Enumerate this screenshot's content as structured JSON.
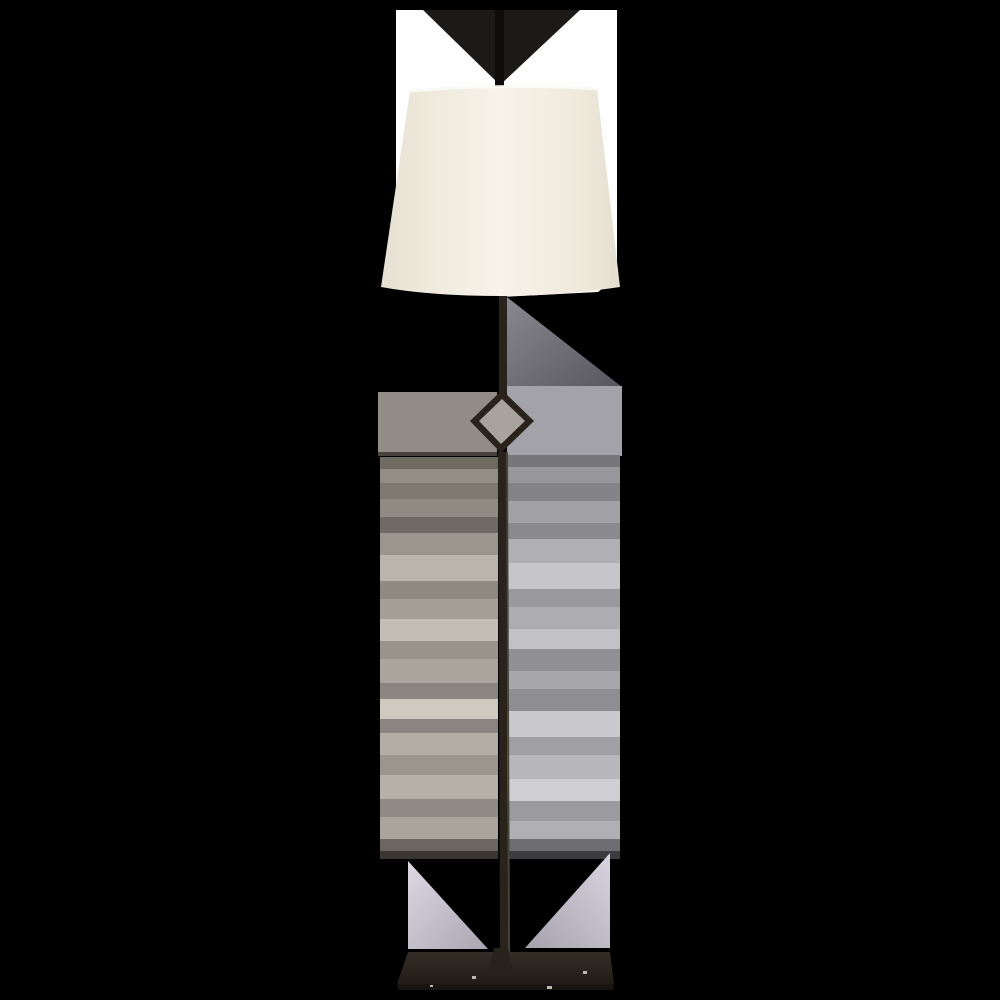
{
  "scene": {
    "subject": "wrought-iron floor lamp product photo with linen shade, diamond stem ornament and rectangular base on matted white/black background",
    "canvas": {
      "width": 1000,
      "height": 1000
    },
    "colors": {
      "background": "#000000",
      "photo_white": "#fefefe",
      "notch_triangle": "#1b1a18",
      "stem_top": "#0e0c0a",
      "stem_mid": "#29231c",
      "stem_edge": "#4a4238",
      "shade_top_highlight": "#fbfaf5",
      "band_left": "#918d86",
      "band_right": "#a2a2a8",
      "seam_line": "#46433c",
      "base_front": "#171411",
      "base_speck": "#d8d3c8",
      "diamond_outline": "#2a231b",
      "diamond_inner": "#a8a49d",
      "collar": "#27221c"
    },
    "gradients": {
      "shade": [
        "#e6e0d2",
        "#efe9dc",
        "#f7f3e8",
        "#efe9dc",
        "#e4decf"
      ],
      "tri_below_shade": [
        "#8b8992",
        "#56545c"
      ],
      "wedge_left": [
        "#ded9e4",
        "#a9a5b1"
      ],
      "wedge_right": [
        "#d8d4e0",
        "#a5a1ad"
      ],
      "base_top": [
        "#332d25",
        "#211c16"
      ]
    },
    "streaks": {
      "left": {
        "x": 380,
        "w": 118,
        "bands": [
          [
            457,
            12,
            "#6e6a62"
          ],
          [
            469,
            14,
            "#928d85"
          ],
          [
            483,
            16,
            "#7d7971"
          ],
          [
            499,
            18,
            "#8f8b83"
          ],
          [
            517,
            16,
            "#6f6b64"
          ],
          [
            533,
            22,
            "#9a958d"
          ],
          [
            555,
            26,
            "#b9b4ac"
          ],
          [
            581,
            18,
            "#8e8a82"
          ],
          [
            599,
            20,
            "#a39e96"
          ],
          [
            619,
            22,
            "#c2bdb5"
          ],
          [
            641,
            18,
            "#98938b"
          ],
          [
            659,
            24,
            "#aaa59d"
          ],
          [
            683,
            16,
            "#8b8680"
          ],
          [
            699,
            20,
            "#cfc9c0"
          ],
          [
            719,
            14,
            "#8a8580"
          ],
          [
            733,
            22,
            "#b3ada5"
          ],
          [
            755,
            20,
            "#9b958d"
          ],
          [
            775,
            24,
            "#b6b0a8"
          ],
          [
            799,
            18,
            "#8f8a83"
          ],
          [
            817,
            22,
            "#a9a49c"
          ],
          [
            839,
            12,
            "#6b6760"
          ],
          [
            851,
            8,
            "#3a3732"
          ]
        ]
      },
      "right": {
        "x": 507,
        "w": 113,
        "bands": [
          [
            455,
            12,
            "#77777a"
          ],
          [
            467,
            16,
            "#98989c"
          ],
          [
            483,
            18,
            "#848488"
          ],
          [
            501,
            22,
            "#a2a2a6"
          ],
          [
            523,
            16,
            "#8a8a8e"
          ],
          [
            539,
            24,
            "#b0b0b4"
          ],
          [
            563,
            26,
            "#c6c6ca"
          ],
          [
            589,
            18,
            "#9a9a9e"
          ],
          [
            607,
            22,
            "#adadb1"
          ],
          [
            629,
            20,
            "#c2c2c6"
          ],
          [
            649,
            22,
            "#919195"
          ],
          [
            671,
            18,
            "#a7a7ab"
          ],
          [
            689,
            22,
            "#8e8e92"
          ],
          [
            711,
            26,
            "#c9c9cd"
          ],
          [
            737,
            18,
            "#a0a0a4"
          ],
          [
            755,
            24,
            "#b8b8bc"
          ],
          [
            779,
            22,
            "#cfcfd3"
          ],
          [
            801,
            20,
            "#9b9b9f"
          ],
          [
            821,
            18,
            "#b0b0b4"
          ],
          [
            839,
            12,
            "#6e6e72"
          ],
          [
            851,
            8,
            "#3c3c40"
          ]
        ]
      }
    },
    "specks": [
      [
        472,
        976,
        4,
        3
      ],
      [
        583,
        971,
        4,
        3
      ],
      [
        547,
        986,
        5,
        3
      ],
      [
        430,
        985,
        3,
        2
      ]
    ]
  }
}
